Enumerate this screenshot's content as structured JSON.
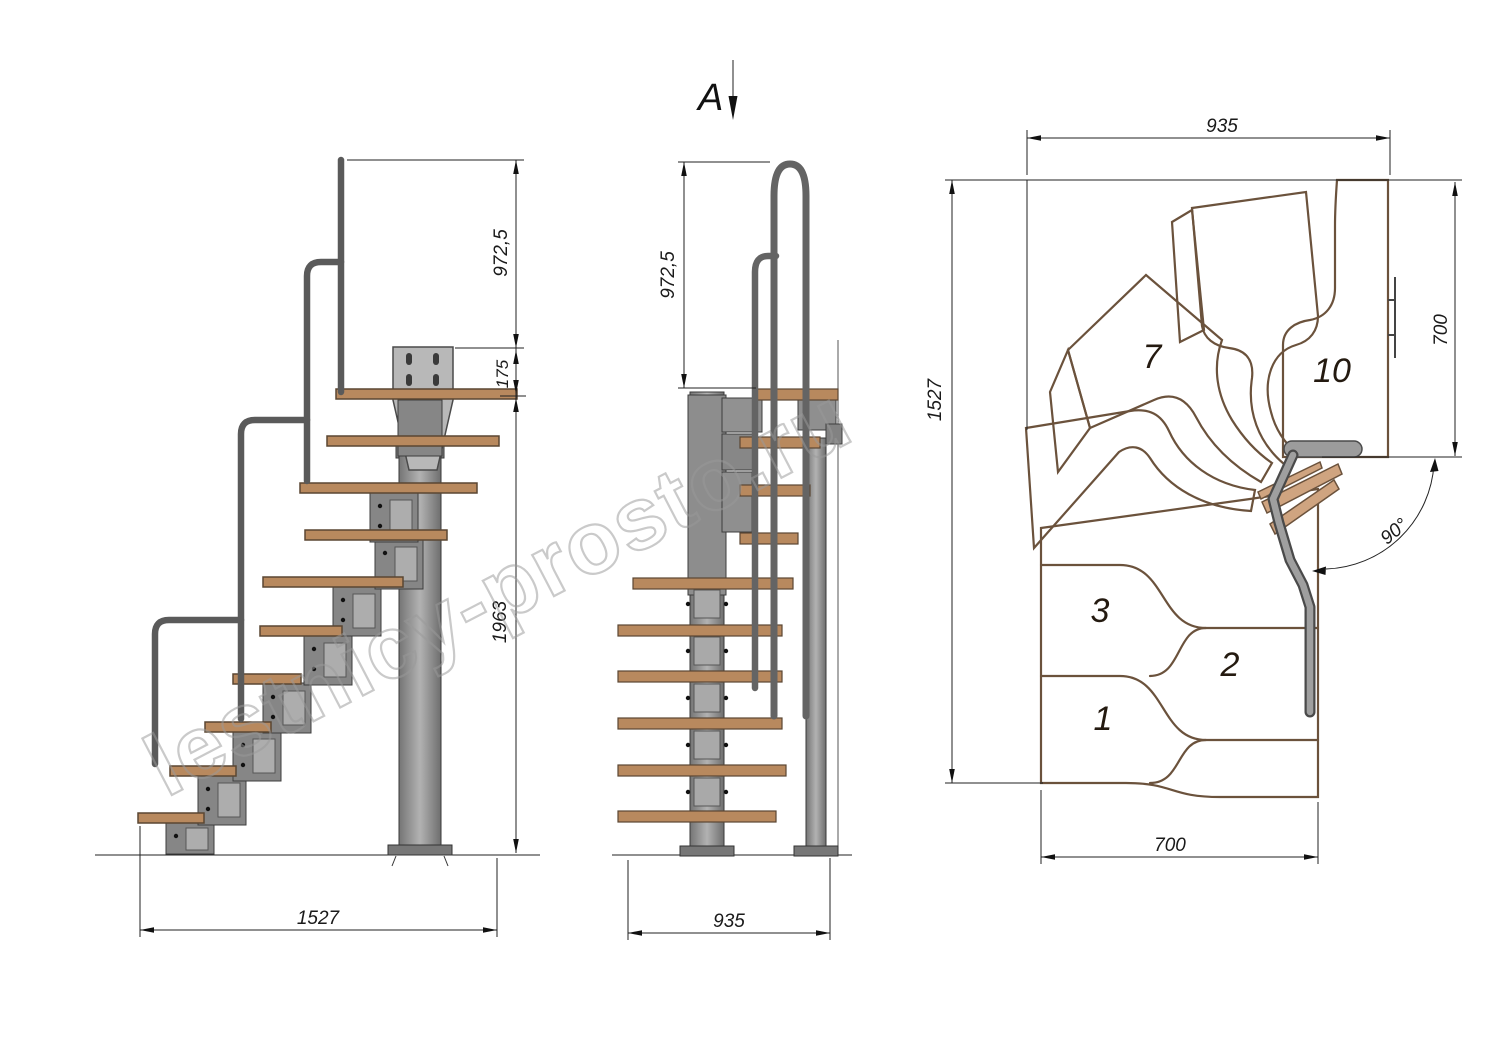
{
  "watermark": "lestnicy-prosto.ru",
  "section_marker": "A",
  "side_view": {
    "dim_rail_height": "972,5",
    "dim_landing_drop": "175",
    "dim_height": "1963",
    "dim_length": "1527"
  },
  "front_view": {
    "dim_rail_height": "972,5",
    "dim_width": "935"
  },
  "plan_view": {
    "dim_width_top": "935",
    "dim_depth_right": "700",
    "dim_length_left": "1527",
    "dim_width_bottom": "700",
    "dim_angle": "90°",
    "step_numbers": {
      "s1": "1",
      "s2": "2",
      "s3": "3",
      "s7": "7",
      "s10": "10"
    }
  }
}
